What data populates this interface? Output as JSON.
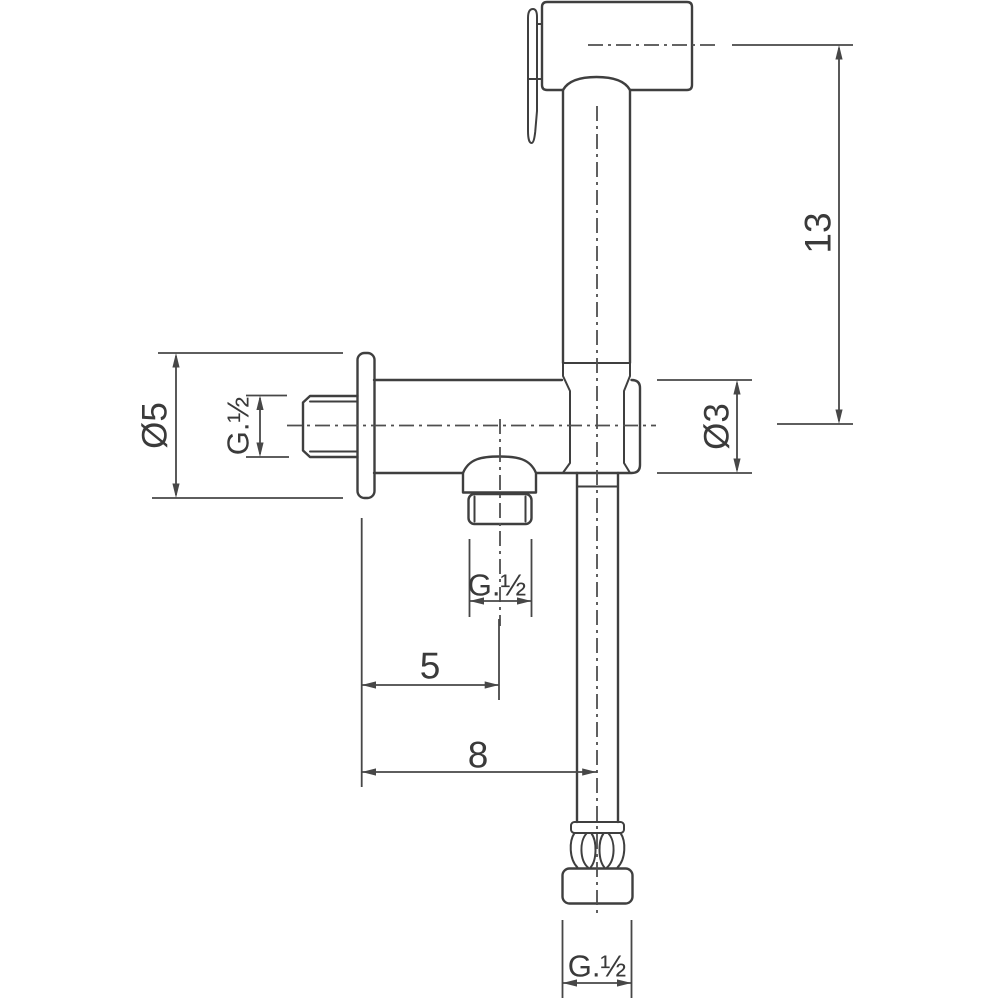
{
  "drawing": {
    "subject": "Wall-mounted bidet hand shower set with angle valve — dimensioned outline drawing",
    "background_color": "#ffffff",
    "line_color": "#3f3f3f",
    "dimension_color": "#474747",
    "dimensions": {
      "overall_height": {
        "label": "13"
      },
      "flange_diameter": {
        "label": "Ø5"
      },
      "inlet_thread": {
        "label": "G.½"
      },
      "valve_body_diameter": {
        "label": "Ø3"
      },
      "outlet_thread": {
        "label": "G.½"
      },
      "outlet_offset": {
        "label": "5"
      },
      "hose_offset": {
        "label": "8"
      },
      "hose_thread": {
        "label": "G.½"
      }
    }
  }
}
